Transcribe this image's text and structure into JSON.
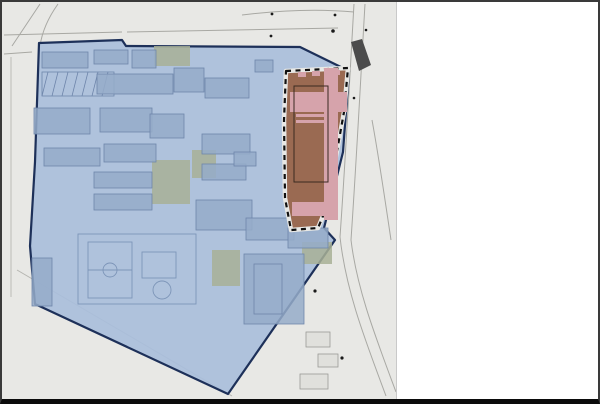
{
  "watermark": {
    "line1": "好房網",
    "line2": "HouseFun News"
  },
  "map": {
    "phase1_label": "第一期發展區",
    "phase2_label": "第二期發展區",
    "colors": {
      "phase1_fill": "#a9bedb",
      "phase1_border": "#1d3059",
      "phase2_fill": "#9a6a52",
      "phase2_accent": "#d6a3ab",
      "marker_fill": "#e9edf2",
      "marker_border": "#5f6b7d",
      "marker2_fill": "#7d2433",
      "map_background": "#e8e8e5"
    },
    "markers": [
      {
        "n": "1",
        "x": 224,
        "y": 87
      },
      {
        "n": "2",
        "x": 299,
        "y": 135,
        "maroon": true
      },
      {
        "n": "3",
        "x": 156,
        "y": 244
      },
      {
        "n": "4",
        "x": 43,
        "y": 281
      },
      {
        "n": "5",
        "x": 188,
        "y": 79
      },
      {
        "n": "6",
        "x": 165,
        "y": 126
      },
      {
        "n": "7",
        "x": 124,
        "y": 180
      },
      {
        "n": "7",
        "x": 125,
        "y": 202
      },
      {
        "n": "8",
        "x": 71,
        "y": 157
      },
      {
        "n": "8",
        "x": 127,
        "y": 155
      },
      {
        "n": "9",
        "x": 52,
        "y": 120
      },
      {
        "n": "10",
        "x": 130,
        "y": 80
      },
      {
        "n": "11",
        "x": 244,
        "y": 183
      },
      {
        "n": "12",
        "x": 221,
        "y": 214
      },
      {
        "n": "12",
        "x": 266,
        "y": 229
      },
      {
        "n": "12",
        "x": 301,
        "y": 239
      },
      {
        "n": "13",
        "x": 221,
        "y": 173
      },
      {
        "n": "14",
        "x": 223,
        "y": 146
      },
      {
        "n": "15",
        "x": 123,
        "y": 119
      },
      {
        "n": "16",
        "x": 67,
        "y": 72
      },
      {
        "n": "17",
        "x": 277,
        "y": 287
      },
      {
        "n": "18",
        "x": 329,
        "y": 62
      },
      {
        "n": "19",
        "x": 270,
        "y": 65
      }
    ]
  },
  "legend": {
    "items": [
      {
        "num": "1",
        "text": "旅客諮詢中心"
      },
      {
        "num": "2",
        "text": "園區主建築(新建國家人權博物館館舍位置)"
      },
      {
        "num": "3",
        "text": "仁愛樓"
      },
      {
        "num": "4",
        "text": "軍情局看守所"
      },
      {
        "num": "5",
        "text": "第一法庭"
      },
      {
        "num": "6",
        "text": "軍事法庭"
      },
      {
        "num": "7",
        "text": "特展室"
      },
      {
        "num": "8",
        "text": "教育討論空間"
      },
      {
        "num": "9",
        "text": "汪希苓軟禁區"
      },
      {
        "num": "10",
        "text": "休憩咖啡"
      },
      {
        "num": "11",
        "text": "主題書店"
      },
      {
        "num": "12",
        "text": "多功能展演空間"
      },
      {
        "num": "13",
        "text": "公共廁所"
      },
      {
        "num": "14",
        "text": "志工休息室與培訓教室"
      },
      {
        "num": "15",
        "text": "交流廣場"
      },
      {
        "num": "16",
        "text": "大客車停車場"
      },
      {
        "num": "17",
        "text": "學人與執勤宿舍"
      },
      {
        "num": "18",
        "text": "入口廣場"
      },
      {
        "num": "19",
        "text": "小客車地下停車場出入口"
      }
    ]
  }
}
